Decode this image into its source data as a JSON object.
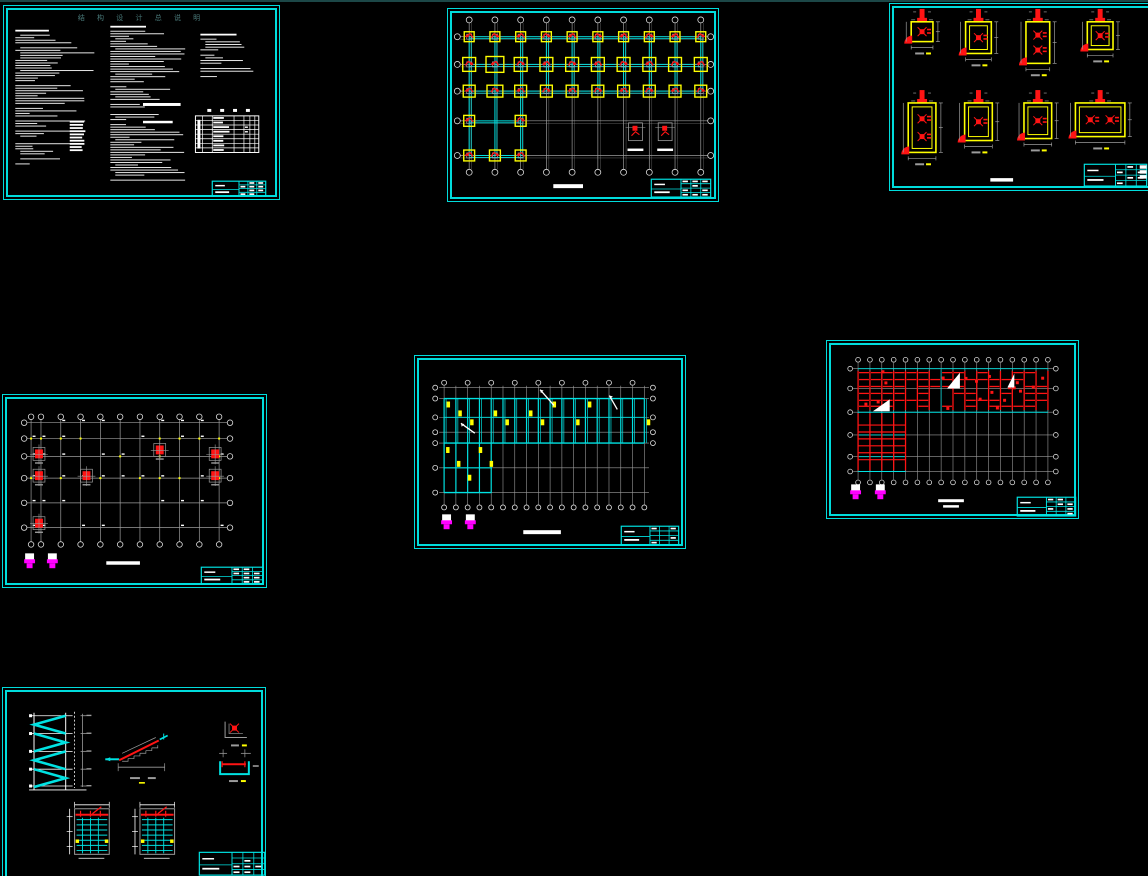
{
  "app": {
    "canvas_background": "#000000",
    "top_strip_color": "#1c4747"
  },
  "palette": {
    "cyan": "#00e2e2",
    "yellow": "#ffff00",
    "red": "#ff1414",
    "magenta": "#ff00ff",
    "white": "#f2f2f2",
    "gray": "#9c9c9c",
    "title_text": "#4a7a7a"
  },
  "sheets": [
    {
      "id": "general-notes",
      "title": "结 构 设 计 总 说 明",
      "text_columns": 3,
      "note_table_rows": 8
    },
    {
      "id": "foundation-plan",
      "grid_columns": 10,
      "grid_rows": 5,
      "pad_rows": [
        10,
        10,
        10,
        2,
        3
      ]
    },
    {
      "id": "footing-details",
      "detail_count": 8,
      "rows": 2,
      "columns": 4
    },
    {
      "id": "column-layout-plan",
      "grid_columns": 11,
      "grid_rows": 6,
      "column_marks": 7,
      "section_markers": 2
    },
    {
      "id": "floor-framing-plan",
      "grid_columns": 18,
      "wing_beams": 5,
      "section_markers": 2
    },
    {
      "id": "beam-reinforcement-plan",
      "grid_columns": 17,
      "section_triangles": 3,
      "section_markers": 2
    },
    {
      "id": "stair-details",
      "flights": 4,
      "plan_details": 2
    }
  ]
}
